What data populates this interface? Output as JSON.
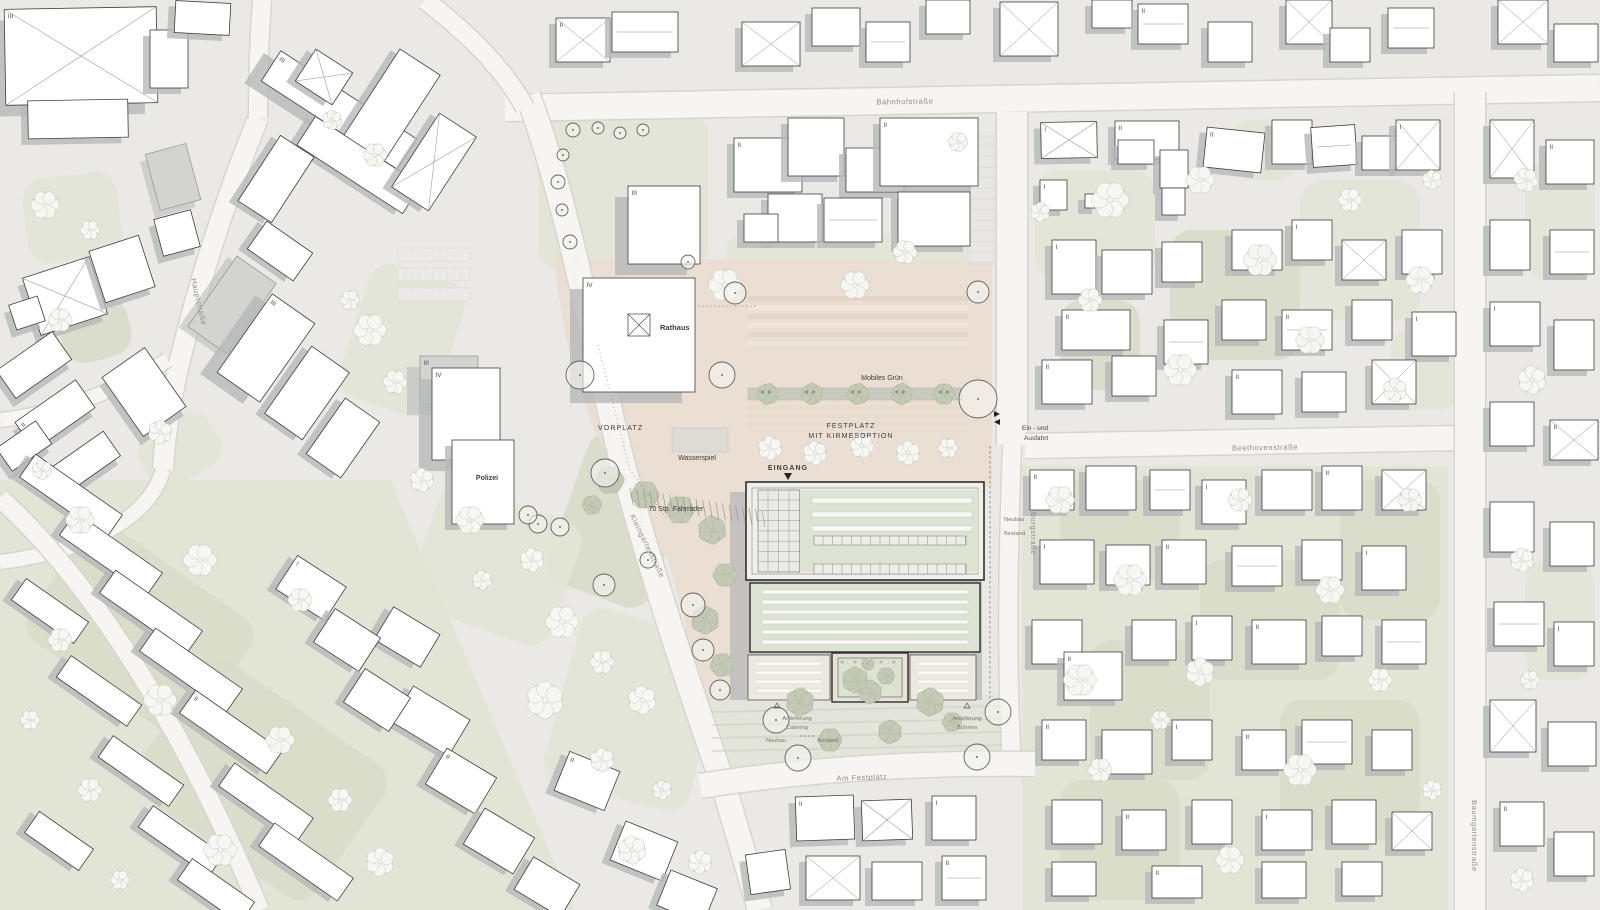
{
  "plan": {
    "streets": {
      "bahnhofstrasse": "Bahnhofstraße",
      "hauptstrasse": "Hauptstraße",
      "kleingartenstrasse": "Kleingartenstraße",
      "burgstrasse": "Burgstraße",
      "beethovenstrasse": "Beethovenstraße",
      "am_festplatz": "Am Festplatz",
      "baumgartenstrasse": "Baumgartenstraße"
    },
    "labels": {
      "rathaus": "Rathaus",
      "polizei": "Polizei",
      "vorplatz": "VORPLATZ",
      "wasserspiel": "Wasserspiel",
      "eingang": "EINGANG",
      "fahrraeder": "70 Stp. Fahrräder",
      "festplatz_line1": "FESTPLATZ",
      "festplatz_line2": "MIT KIRMESOPTION",
      "mobiles_gruen": "Mobiles Grün",
      "ein_und": "Ein - und",
      "ausfahrt": "Ausfahrt",
      "neubau": "Neubau",
      "bestand": "Bestand",
      "anlieferung": "Anlieferung",
      "catering": "Catering",
      "buehnen": "Bühnen"
    },
    "storeys": {
      "I": "I",
      "II": "II",
      "III": "III",
      "IV": "IV"
    },
    "colors": {
      "ground": "#eae9e5",
      "green": "#e2e4d6",
      "green_dark": "#d8dcc9",
      "road": "#f6f5f1",
      "road_edge": "#d7d5d0",
      "building": "#ffffff",
      "building_line": "#3e3e3c",
      "building_gray": "#d3d4d2",
      "shadow": "#b6b8b9",
      "plaza": "#ebdfd3",
      "plaza_stripe": "#e0d2c3",
      "roof_green": "#dde3d3",
      "roof_strip": "#f7f7f3",
      "ink": "#2f2f2d"
    }
  }
}
